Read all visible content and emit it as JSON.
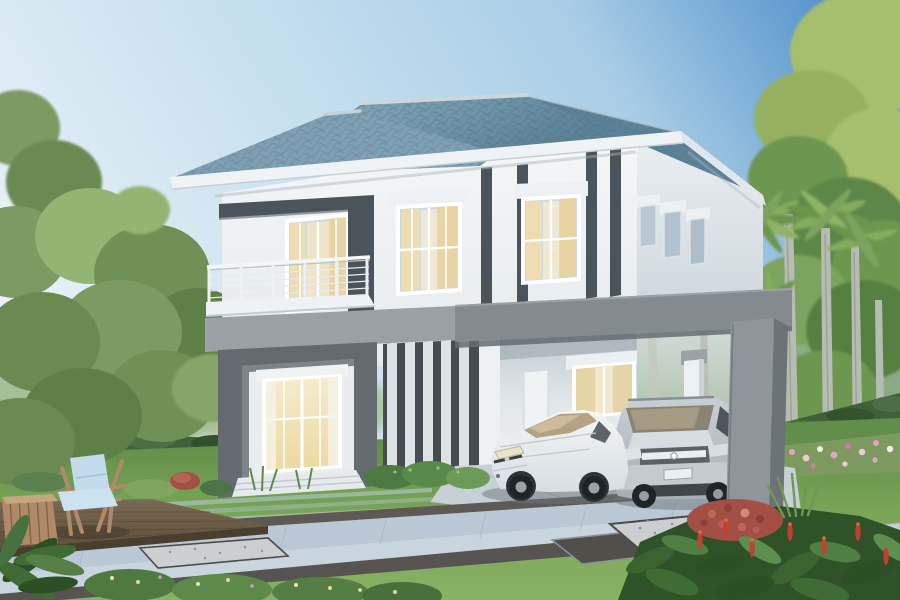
{
  "scene": {
    "objects": [
      "two-story-modern-house",
      "blue-hip-roof",
      "balcony-with-railing",
      "dark-accent-canopy",
      "vertical-louver-screen",
      "gray-carport-frame",
      "white-sedan",
      "silver-suv",
      "curtained-windows",
      "glowing-ground-floor-window",
      "left-shade-tree",
      "palm-trees",
      "right-leafy-trees",
      "garden-hedge",
      "pink-flower-bed",
      "striped-lawn",
      "paver-walkway",
      "gravel-inlays",
      "wooden-deck",
      "lounge-chair",
      "wicker-side-table",
      "foreground-garden"
    ],
    "palette": {
      "sky_deep": "#4a8cc8",
      "sky_mid": "#a9cde6",
      "sky_light": "#edf4f8",
      "roof_light": "#7da0b4",
      "roof_dark": "#5d8298",
      "roof_ridge": "#ccd6dc",
      "fascia": "#eff3f5",
      "wall": "#f4f6f7",
      "wall_side": "#e9eef2",
      "accent_dark": "#4b545b",
      "band_gray": "#99a1a7",
      "carport_gray": "#838b91",
      "carport_side": "#6c7378",
      "portal_gray": "#636b71",
      "louver_dark": "#454d52",
      "louver_slat": "#dde2e5",
      "curtain_cream": "#eedcb2",
      "window_glow": "#f6ecd0",
      "glass": "#cfdae0",
      "grass": "#7aa557",
      "grass_far": "#618e4a",
      "hedge_green": "#40603c",
      "tree_green": "#7d9a63",
      "tree_dark": "#5e8048",
      "tree_light": "#93b573",
      "tree_yellow": "#a6bf6e",
      "palm_trunk": "#b6bcb1",
      "paver_blue": "#b9c8d4",
      "paver_light": "#c8d5de",
      "path_dark": "#5e5954",
      "gravel": "#cbcfd2",
      "concrete": "#c7d0d6",
      "deck_wood": "#6f5d48",
      "furniture_wood": "#b08968",
      "cushion_blue": "#c3dbea",
      "car_white": "#f4f6f7",
      "car_silver": "#c8cfd5",
      "tire_black": "#1f2428",
      "flower_pink": "#dfa6c4",
      "flower_red": "#c33f30",
      "coleus_red": "#a34f46"
    }
  }
}
